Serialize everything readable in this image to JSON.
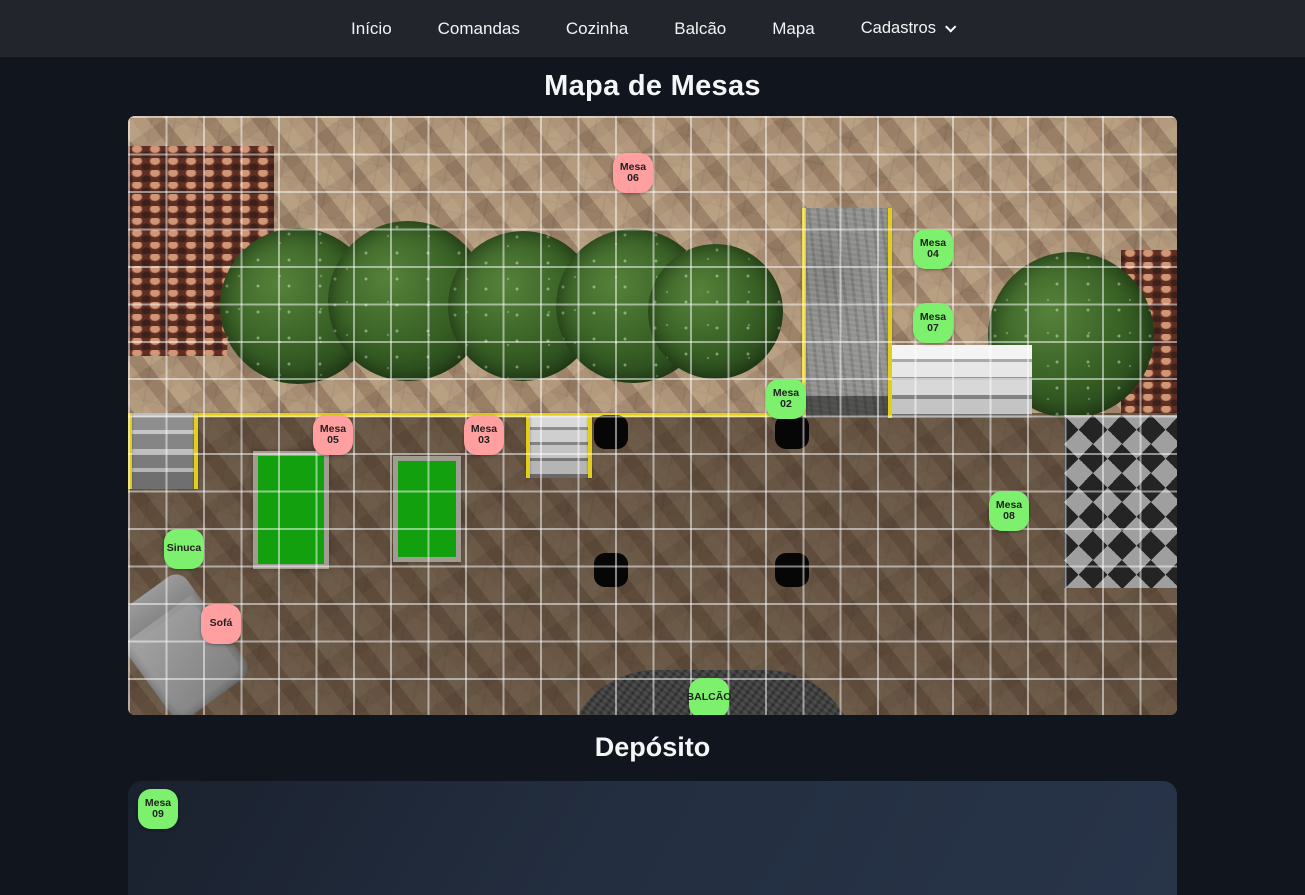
{
  "nav": {
    "items": [
      {
        "id": "inicio",
        "label": "Início"
      },
      {
        "id": "comandas",
        "label": "Comandas"
      },
      {
        "id": "cozinha",
        "label": "Cozinha"
      },
      {
        "id": "balcao",
        "label": "Balcão"
      },
      {
        "id": "mapa",
        "label": "Mapa"
      }
    ],
    "dropdown": {
      "label": "Cadastros",
      "icon": "chevron-down-icon"
    }
  },
  "page": {
    "map_title": "Mapa de Mesas",
    "deposito_title": "Depósito"
  },
  "colors": {
    "table_free": "#7df16d",
    "table_occupied": "#ff9f9f",
    "accent_yellow": "#e3ce1c"
  },
  "map": {
    "tables": [
      {
        "id": "mesa-06",
        "label": "Mesa 06",
        "status": "occupied",
        "x": 505,
        "y": 57
      },
      {
        "id": "mesa-04",
        "label": "Mesa 04",
        "status": "free",
        "x": 805,
        "y": 133
      },
      {
        "id": "mesa-07",
        "label": "Mesa 07",
        "status": "free",
        "x": 805,
        "y": 207
      },
      {
        "id": "mesa-02",
        "label": "Mesa 02",
        "status": "free",
        "x": 658,
        "y": 283
      },
      {
        "id": "mesa-05",
        "label": "Mesa 05",
        "status": "occupied",
        "x": 205,
        "y": 319
      },
      {
        "id": "mesa-03",
        "label": "Mesa 03",
        "status": "occupied",
        "x": 356,
        "y": 319
      },
      {
        "id": "mesa-08",
        "label": "Mesa 08",
        "status": "free",
        "x": 881,
        "y": 395
      },
      {
        "id": "sinuca",
        "label": "Sinuca",
        "status": "free",
        "x": 56,
        "y": 433
      },
      {
        "id": "sofa",
        "label": "Sofá",
        "status": "occupied",
        "x": 93,
        "y": 508
      },
      {
        "id": "balcao",
        "label": "BALCÃO",
        "status": "free",
        "x": 581,
        "y": 582
      }
    ]
  },
  "deposito": {
    "tables": [
      {
        "id": "mesa-09",
        "label": "Mesa 09",
        "status": "free",
        "x": 30,
        "y": 28
      }
    ]
  }
}
